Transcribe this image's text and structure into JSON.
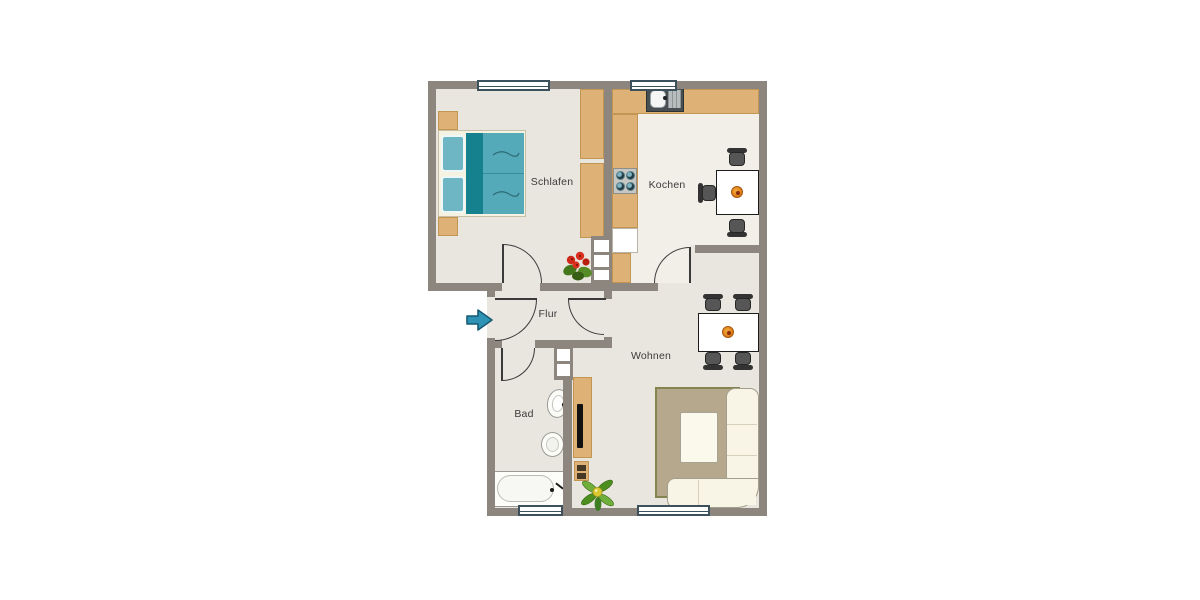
{
  "floorplan": {
    "rooms": [
      {
        "id": "schlafen",
        "label": "Schlafen"
      },
      {
        "id": "kochen",
        "label": "Kochen"
      },
      {
        "id": "flur",
        "label": "Flur"
      },
      {
        "id": "bad",
        "label": "Bad"
      },
      {
        "id": "wohnen",
        "label": "Wohnen"
      }
    ],
    "icons": {
      "entrance": "entrance-arrow-icon"
    },
    "colors": {
      "wall": "#8c867e",
      "floor": "#e9e6df",
      "kitchen_floor": "#f2efe8",
      "wood": "#deb277",
      "wood_border": "#c29552",
      "bed_duvet": "#55aab9",
      "bed_stripe": "#15818f",
      "bed_pillow": "#6fb6c4",
      "rug": "#b6a88c",
      "rug_border": "#84844e",
      "sofa": "#f9f5e6",
      "arrow": "#2e93b4",
      "window_frame": "#3d515c",
      "label_text": "#3b3b3b",
      "door_line": "#3a3a3a",
      "plant_green": "#4c8f1f",
      "plant_red": "#d92f1e"
    }
  }
}
